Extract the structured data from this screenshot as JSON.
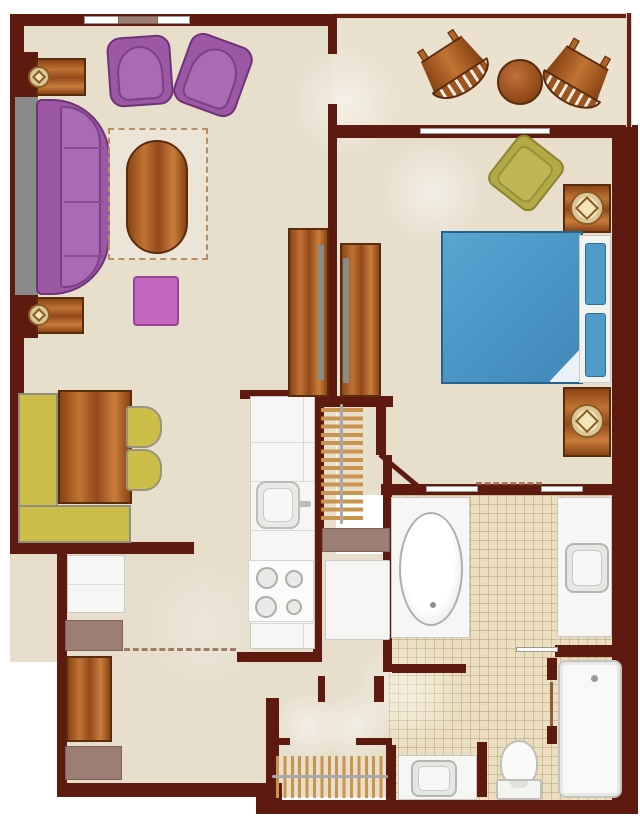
{
  "figure": "one-bedroom-villa-floor-plan",
  "palette": {
    "wall": "#5F1A10",
    "floor": "#E7DECC",
    "tile": "#EBDFC0",
    "wood": "#B06426",
    "purple": "#9C57A5",
    "magenta": "#C468BF",
    "yellow": "#CDBE4A",
    "olive": "#B3AA45",
    "bed_blue": "#4E9AC8",
    "fixture_white": "#F6F6F4",
    "mauve": "#9D7E75",
    "gray": "#8A8A88",
    "lamp_cream": "#F3E5BA"
  },
  "rooms": [
    {
      "name": "living-room",
      "furniture": [
        {
          "item": "sectional-sofa",
          "count": 1
        },
        {
          "item": "armchair",
          "count": 2
        },
        {
          "item": "oval-coffee-table",
          "count": 1
        },
        {
          "item": "area-rug",
          "count": 1
        },
        {
          "item": "end-table-with-lamp",
          "count": 2
        },
        {
          "item": "ottoman",
          "count": 1
        }
      ]
    },
    {
      "name": "dining-area",
      "furniture": [
        {
          "item": "l-shaped-banquette",
          "count": 1
        },
        {
          "item": "dining-table",
          "count": 1
        },
        {
          "item": "dining-chair",
          "count": 2
        }
      ]
    },
    {
      "name": "kitchen",
      "furniture": [
        {
          "item": "counter-run",
          "count": 1
        },
        {
          "item": "sink",
          "count": 1
        },
        {
          "item": "range-4-burner",
          "count": 1
        }
      ]
    },
    {
      "name": "balcony",
      "furniture": [
        {
          "item": "rocking-chair",
          "count": 2
        },
        {
          "item": "round-table",
          "count": 1
        }
      ]
    },
    {
      "name": "bedroom",
      "furniture": [
        {
          "item": "bed-with-headboard",
          "count": 1
        },
        {
          "item": "nightstand-with-lamp",
          "count": 2
        },
        {
          "item": "lounge-chair",
          "count": 1
        },
        {
          "item": "wardrobe-panel",
          "count": 2
        },
        {
          "item": "closet-hanging-rod",
          "count": 1
        }
      ]
    },
    {
      "name": "bathroom",
      "furniture": [
        {
          "item": "soaking-tub-vanity",
          "count": 1
        },
        {
          "item": "sink-vanity",
          "count": 3
        },
        {
          "item": "walk-in-shower",
          "count": 1
        },
        {
          "item": "toilet",
          "count": 1
        }
      ]
    },
    {
      "name": "entry-hall",
      "furniture": [
        {
          "item": "cabinet",
          "count": 1
        },
        {
          "item": "console-table",
          "count": 1
        },
        {
          "item": "bench",
          "count": 2
        },
        {
          "item": "coat-closet-hangers",
          "count": 1
        }
      ]
    }
  ]
}
